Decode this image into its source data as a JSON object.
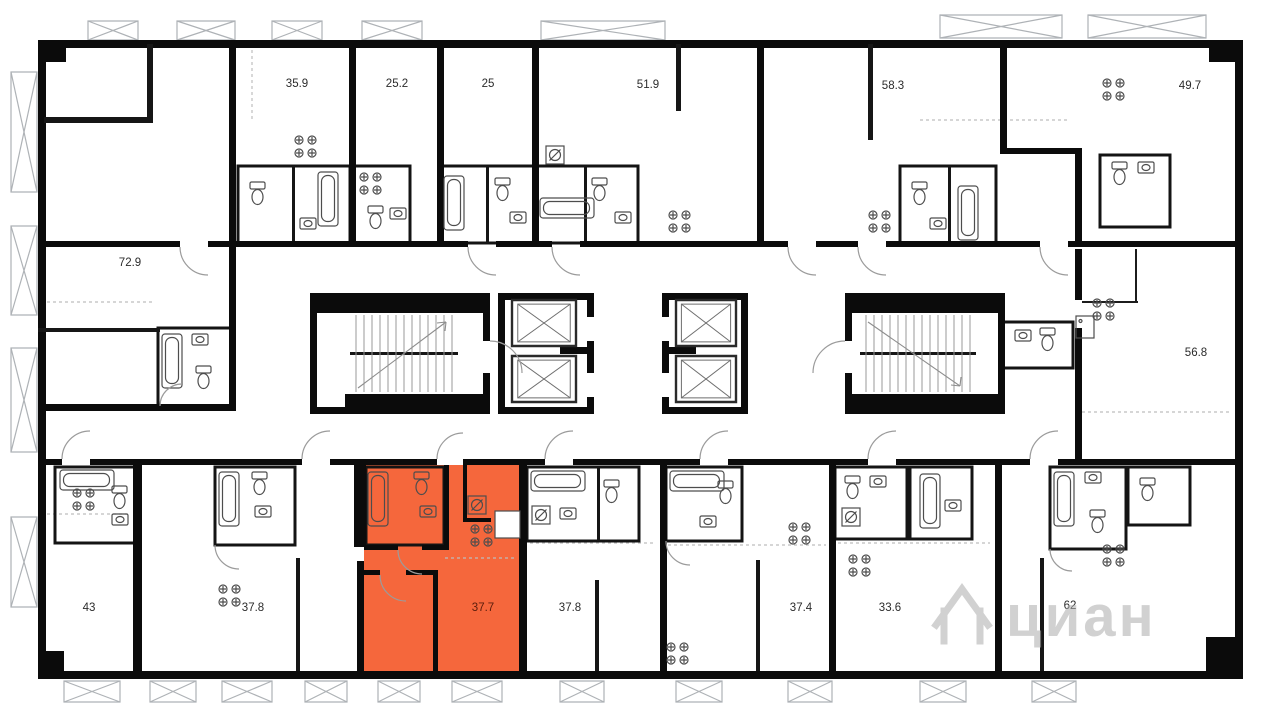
{
  "page": {
    "type": "residential-floor-plan"
  },
  "watermark": {
    "text": "циан",
    "icon": "house-logo-icon"
  },
  "colors": {
    "wall": "#0b0b0b",
    "highlight": "#f5673c",
    "label": "#2b2b2b",
    "label_on_highlight": "#5a1d0c",
    "fixture_stroke": "#4d4d4d",
    "door_arc": "#9b9b9b",
    "balcony_stroke": "#aeb2b6",
    "watermark": "#adadad"
  },
  "units": [
    {
      "id": "unit-72-9",
      "area": "72.9",
      "highlighted": false
    },
    {
      "id": "unit-35-9",
      "area": "35.9",
      "highlighted": false
    },
    {
      "id": "unit-25-2",
      "area": "25.2",
      "highlighted": false
    },
    {
      "id": "unit-25",
      "area": "25",
      "highlighted": false
    },
    {
      "id": "unit-51-9",
      "area": "51.9",
      "highlighted": false
    },
    {
      "id": "unit-58-3",
      "area": "58.3",
      "highlighted": false
    },
    {
      "id": "unit-49-7",
      "area": "49.7",
      "highlighted": false
    },
    {
      "id": "unit-56-8",
      "area": "56.8",
      "highlighted": false
    },
    {
      "id": "unit-43",
      "area": "43",
      "highlighted": false
    },
    {
      "id": "unit-37-8-a",
      "area": "37.8",
      "highlighted": false
    },
    {
      "id": "unit-37-7",
      "area": "37.7",
      "highlighted": true
    },
    {
      "id": "unit-37-8-b",
      "area": "37.8",
      "highlighted": false
    },
    {
      "id": "unit-37-4",
      "area": "37.4",
      "highlighted": false
    },
    {
      "id": "unit-33-6",
      "area": "33.6",
      "highlighted": false
    },
    {
      "id": "unit-62",
      "area": "62",
      "highlighted": false
    }
  ],
  "icons": {
    "bathtub": "bathtub-icon",
    "toilet": "toilet-icon",
    "sink": "sink-icon",
    "stove": "stove-icon",
    "washer": "washer-icon",
    "fridge": "fridge-icon",
    "elevator": "elevator-shaft-icon",
    "stairs": "stairs-icon",
    "balcony": "balcony-icon",
    "watermark_house": "house-logo-icon"
  }
}
